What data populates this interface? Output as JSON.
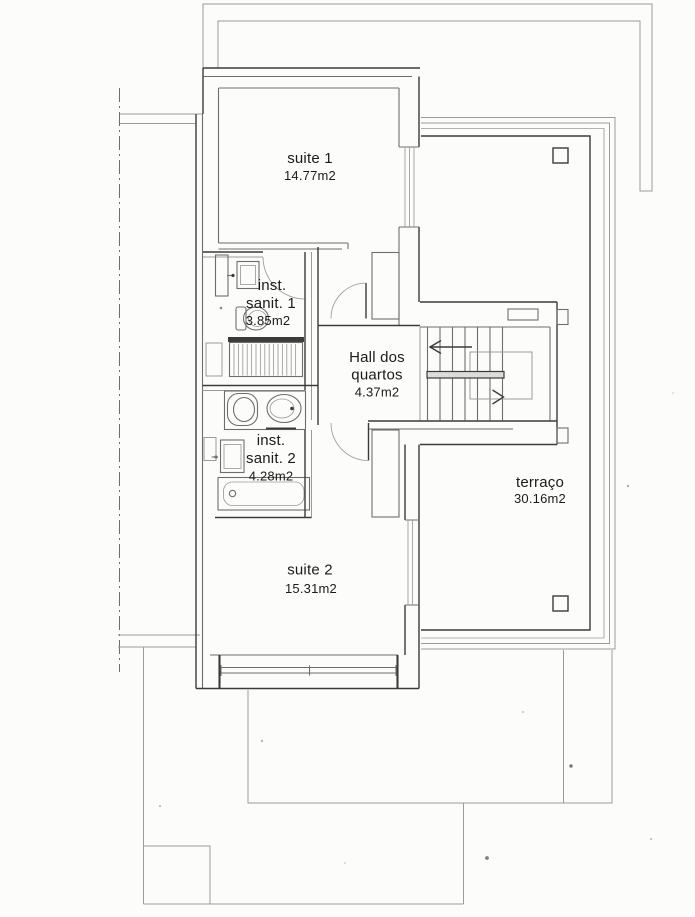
{
  "rooms": {
    "suite1": {
      "name": "suite 1",
      "area": "14.77m2"
    },
    "sanit1": {
      "line1": "inst.",
      "line2": "sanit. 1",
      "area": "3.85m2"
    },
    "hall": {
      "line1": "Hall dos",
      "line2": "quartos",
      "area": "4.37m2"
    },
    "sanit2": {
      "line1": "inst.",
      "line2": "sanit. 2",
      "area": "4.28m2"
    },
    "suite2": {
      "name": "suite 2",
      "area": "15.31m2"
    },
    "terrace": {
      "name": "terraço",
      "area": "30.16m2"
    }
  },
  "colors": {
    "paper": "#fcfcfa",
    "ink_light": "#9b9b9b",
    "ink_mid": "#6e6e6e",
    "ink_dark": "#3b3b3b",
    "ink_text": "#1b1b1b"
  }
}
